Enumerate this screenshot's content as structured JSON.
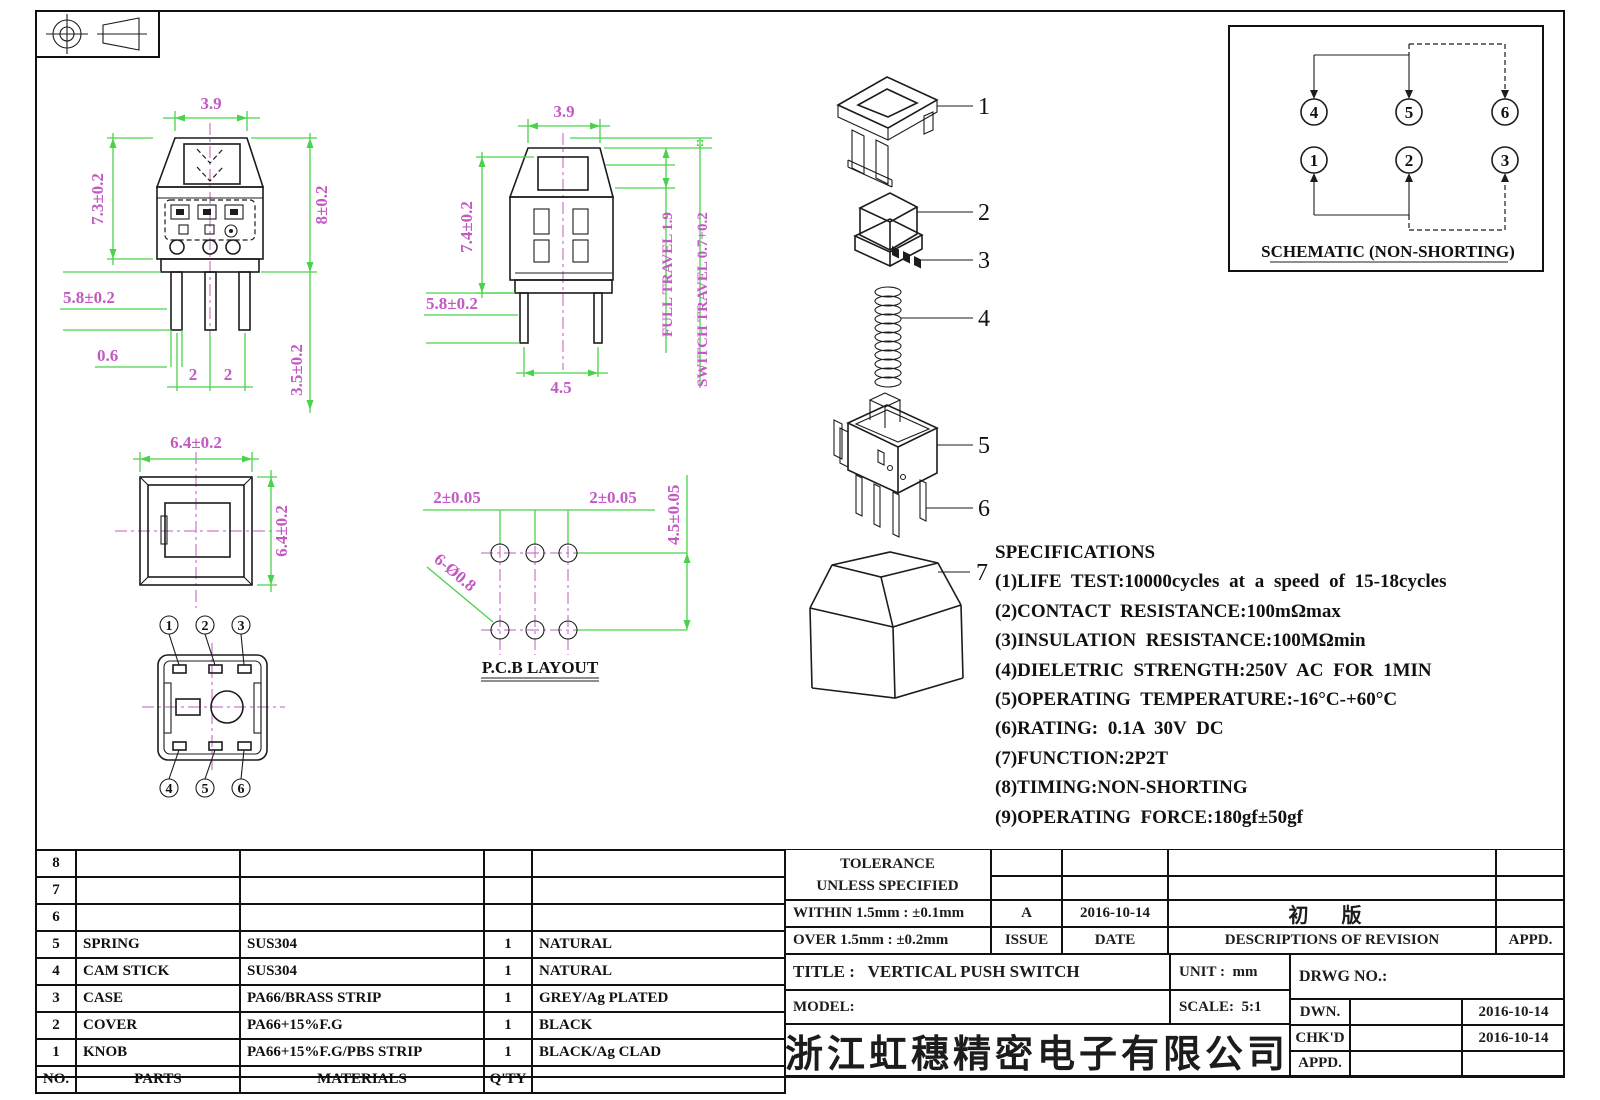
{
  "colors": {
    "dim-green": "#4ad24a",
    "dim-magenta": "#c35ac3",
    "line-black": "#1c1c1c"
  },
  "views": {
    "front": {
      "dim_width": "3.9",
      "dim_height_left": "7.3±0.2",
      "dim_height_right": "8±0.2",
      "dim_pin_length": "5.8±0.2",
      "dim_pin_width": "0.6",
      "dim_pitch_a": "2",
      "dim_pitch_b": "2",
      "dim_pin_depth": "3.5±0.2"
    },
    "side": {
      "dim_width": "3.9",
      "dim_height": "7.4±0.2",
      "dim_pin_length": "5.8±0.2",
      "dim_pin_span": "4.5",
      "full_travel": "FULL TRAVEL 1.9",
      "switch_travel": "SWITCH TRAVEL 0.7+0.2"
    },
    "top": {
      "dim_width": "6.4±0.2",
      "dim_height": "6.4±0.2"
    },
    "bottom": {
      "pin_labels": [
        "1",
        "2",
        "3",
        "4",
        "5",
        "6"
      ]
    },
    "pcb": {
      "dim_pitch_left": "2±0.05",
      "dim_pitch_right": "2±0.05",
      "dim_row_span": "4.5±0.05",
      "dim_holes": "6-Ø0.8",
      "caption": "P.C.B LAYOUT"
    },
    "exploded": {
      "part_labels": [
        "1",
        "2",
        "3",
        "4",
        "5",
        "6",
        "7"
      ]
    },
    "schematic": {
      "caption": "SCHEMATIC (NON-SHORTING)",
      "top_pins": [
        "4",
        "5",
        "6"
      ],
      "bottom_pins": [
        "1",
        "2",
        "3"
      ]
    }
  },
  "specs": {
    "title": "SPECIFICATIONS",
    "items": [
      "(1)LIFE TEST:10000cycles at a speed of 15-18cycles",
      "(2)CONTACT RESISTANCE:100mΩmax",
      "(3)INSULATION RESISTANCE:100MΩmin",
      "(4)DIELETRIC STRENGTH:250V AC FOR 1MIN",
      "(5)OPERATING TEMPERATURE:-16°C-+60°C",
      "(6)RATING: 0.1A 30V DC",
      "(7)FUNCTION:2P2T",
      "(8)TIMING:NON-SHORTING",
      "(9)OPERATING FORCE:180gf±50gf"
    ]
  },
  "parts_table": {
    "rows": [
      {
        "no": "8",
        "parts": "",
        "materials": "",
        "qty": "",
        "color": ""
      },
      {
        "no": "7",
        "parts": "",
        "materials": "",
        "qty": "",
        "color": ""
      },
      {
        "no": "6",
        "parts": "",
        "materials": "",
        "qty": "",
        "color": ""
      },
      {
        "no": "5",
        "parts": "SPRING",
        "materials": "SUS304",
        "qty": "1",
        "color": "NATURAL"
      },
      {
        "no": "4",
        "parts": "CAM STICK",
        "materials": "SUS304",
        "qty": "1",
        "color": "NATURAL"
      },
      {
        "no": "3",
        "parts": "CASE",
        "materials": "PA66/BRASS STRIP",
        "qty": "1",
        "color": "GREY/Ag PLATED"
      },
      {
        "no": "2",
        "parts": "COVER",
        "materials": "PA66+15%F.G",
        "qty": "1",
        "color": "BLACK"
      },
      {
        "no": "1",
        "parts": "KNOB",
        "materials": "PA66+15%F.G/PBS STRIP",
        "qty": "1",
        "color": "BLACK/Ag CLAD"
      }
    ],
    "footer": {
      "no": "NO.",
      "parts": "PARTS",
      "materials": "MATERIALS",
      "qty": "Q'TY",
      "color": ""
    }
  },
  "title_block": {
    "tolerance_line1": "TOLERANCE",
    "tolerance_line2": "UNLESS  SPECIFIED",
    "within": "WITHIN 1.5mm : ±0.1mm",
    "over": "OVER 1.5mm : ±0.2mm",
    "revision": {
      "issue_value": "A",
      "date_value": "2016-10-14",
      "description_value": "初  版",
      "appd_value": "",
      "issue_label": "ISSUE",
      "date_label": "DATE",
      "description_label": "DESCRIPTIONS OF REVISION",
      "appd_label": "APPD."
    },
    "title_label": "TITLE :",
    "title_value": "VERTICAL PUSH SWITCH",
    "unit_label": "UNIT :",
    "unit_value": "mm",
    "model_label": "MODEL:",
    "model_value": "",
    "scale_label": "SCALE:",
    "scale_value": "5:1",
    "drwg_label": "DRWG NO.:",
    "drwg_value": "",
    "company": "浙江虹穗精密电子有限公司",
    "sign_rows": [
      {
        "label": "DWN.",
        "name": "",
        "date": "2016-10-14"
      },
      {
        "label": "CHK'D",
        "name": "",
        "date": "2016-10-14"
      },
      {
        "label": "APPD.",
        "name": "",
        "date": ""
      }
    ]
  }
}
